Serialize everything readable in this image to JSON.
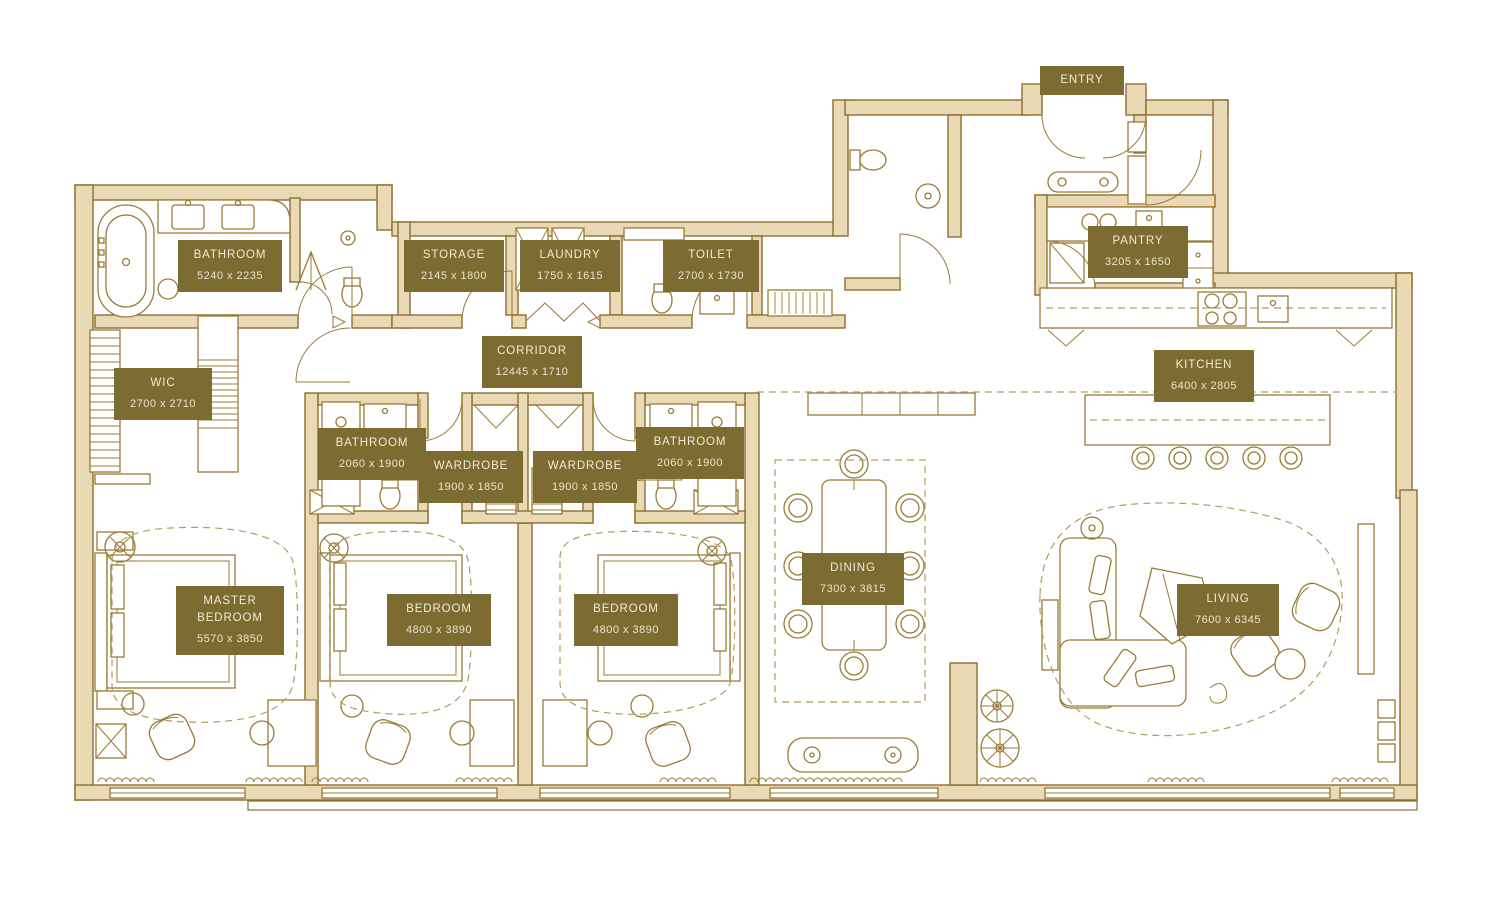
{
  "plan": {
    "colors": {
      "wall_fill": "#ead9b5",
      "wall_stroke": "#8d6e2f",
      "furniture_stroke": "#9a7b35",
      "label_background": "#7d6c31",
      "label_text": "#f1ead7",
      "dashed_stroke": "#b59b5e"
    },
    "rooms": [
      {
        "id": "entry",
        "name": "ENTRY",
        "dims": ""
      },
      {
        "id": "bathroom-master",
        "name": "BATHROOM",
        "dims": "5240 x 2235"
      },
      {
        "id": "storage",
        "name": "STORAGE",
        "dims": "2145 x 1800"
      },
      {
        "id": "laundry",
        "name": "LAUNDRY",
        "dims": "1750 x 1615"
      },
      {
        "id": "toilet",
        "name": "TOILET",
        "dims": "2700 x 1730"
      },
      {
        "id": "pantry",
        "name": "PANTRY",
        "dims": "3205 x 1650"
      },
      {
        "id": "corridor",
        "name": "CORRIDOR",
        "dims": "12445 x 1710"
      },
      {
        "id": "wic",
        "name": "WIC",
        "dims": "2700 x 2710"
      },
      {
        "id": "kitchen",
        "name": "KITCHEN",
        "dims": "6400 x 2805"
      },
      {
        "id": "bathroom-2",
        "name": "BATHROOM",
        "dims": "2060 x 1900"
      },
      {
        "id": "wardrobe-1",
        "name": "WARDROBE",
        "dims": "1900 x 1850"
      },
      {
        "id": "wardrobe-2",
        "name": "WARDROBE",
        "dims": "1900 x 1850"
      },
      {
        "id": "bathroom-3",
        "name": "BATHROOM",
        "dims": "2060 x 1900"
      },
      {
        "id": "master-bedroom",
        "name": "MASTER BEDROOM",
        "dims": "5570 x 3850"
      },
      {
        "id": "bedroom-1",
        "name": "BEDROOM",
        "dims": "4800 x 3890"
      },
      {
        "id": "bedroom-2",
        "name": "BEDROOM",
        "dims": "4800 x 3890"
      },
      {
        "id": "dining",
        "name": "DINING",
        "dims": "7300 x 3815"
      },
      {
        "id": "living",
        "name": "LIVING",
        "dims": "7600 x 6345"
      }
    ]
  }
}
